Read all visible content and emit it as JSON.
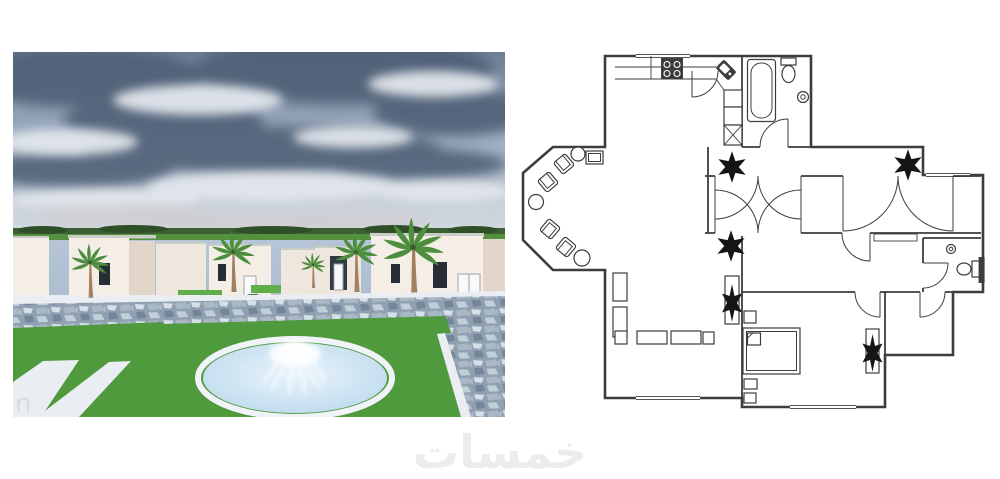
{
  "watermark": {
    "text": "خمسات",
    "fragment": "n"
  },
  "icons": {
    "plant": "six-petal-asterisk",
    "door_swing": "quarter-arc-with-leaf",
    "stove": "four-burner-black-square",
    "kitchen_sink": "rotated-corner-basin",
    "bathtub": "rounded-oval-in-rect",
    "toilet": "tank-and-bowl",
    "wash_basin": "double-circle",
    "armchair": "rotated-rounded-square",
    "side_table": "circle",
    "sofa": "rectangle",
    "bed": "rect-with-pillow-fold",
    "cabinet_x": "crossed-box",
    "palm_tree": "trunk-with-fan-fronds",
    "fountain": "ellipse-pool-with-spray"
  },
  "colors": {
    "page_bg": "#ffffff",
    "watermark": "#ececec",
    "plan_line": "#3d3d3d",
    "plan_bg": "#ffffff",
    "sky_top": "#6e7f95",
    "sky_mid": "#9dadc1",
    "sky_low": "#c7cfda",
    "sky_horizon": "#dde1e6",
    "cloud_dark": "#4d5e74",
    "cloud_light": "#e2e6ec",
    "cloud_pink": "#d6c3bb",
    "haze": "#ccd3dc",
    "treeline": "#3c5f33",
    "treeline_dark": "#2f4f28",
    "field": "#55903f",
    "plaza_top": "#b5c5d7",
    "plaza_bottom": "#9bafc4",
    "bldg_front": "#f5eee7",
    "bldg_front_alt": "#efe6dd",
    "bldg_side": "#e2d5c9",
    "bldg_cap": "#c9cdc8",
    "window_dark": "#272e36",
    "door_white": "#f9f9f9",
    "door_frame": "#9aa3ab",
    "entrance_dark": "#2f3a42",
    "lawn": "#4f9a3d",
    "lawn_bright": "#5fae4a",
    "bush": "#38702e",
    "path_white": "#eaeef3",
    "stone_base": "#8fa0b1",
    "stone_light": "#d7dfe7",
    "stone_mid": "#aab8c6",
    "stone_dark": "#75869a",
    "stone_pale": "#c3cedb",
    "pool_rim": "#f0f4f8",
    "water_center": "#e8f4fc",
    "water_edge": "#bcd9ec",
    "spray": "#ffffff",
    "trunk": "#a08060",
    "frond": "#4d8f3f"
  }
}
